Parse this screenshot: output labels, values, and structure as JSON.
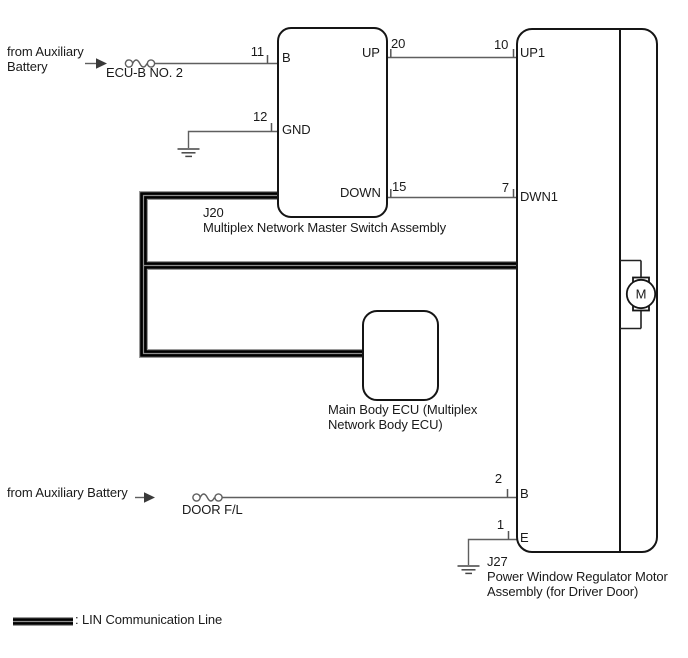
{
  "labels": {
    "source_top": "from Auxiliary Battery",
    "fuse_top": "ECU-B NO. 2",
    "source_bottom": "from Auxiliary Battery",
    "fuse_bottom": "DOOR F/L",
    "legend": ": LIN Communication Line"
  },
  "j20": {
    "ref": "J20",
    "name": "Multiplex Network Master Switch Assembly",
    "pins": {
      "b": {
        "num": "11",
        "label": "B"
      },
      "gnd": {
        "num": "12",
        "label": "GND"
      },
      "up": {
        "num": "20",
        "label": "UP"
      },
      "down": {
        "num": "15",
        "label": "DOWN"
      }
    }
  },
  "main_body_ecu": {
    "name": "Main Body ECU (Multiplex Network Body ECU)"
  },
  "j27": {
    "ref": "J27",
    "name": "Power Window Regulator Motor Assembly (for Driver Door)",
    "motor": "M",
    "pins": {
      "up1": {
        "num": "10",
        "label": "UP1"
      },
      "dwn1": {
        "num": "7",
        "label": "DWN1"
      },
      "b": {
        "num": "2",
        "label": "B"
      },
      "e": {
        "num": "1",
        "label": "E"
      }
    }
  },
  "colors": {
    "line": "#151515",
    "wire": "#5f5f5f",
    "lin_core": "#000000",
    "lin_outline": "#9a9a9a",
    "lin_stripe": "#8f8f8f"
  }
}
